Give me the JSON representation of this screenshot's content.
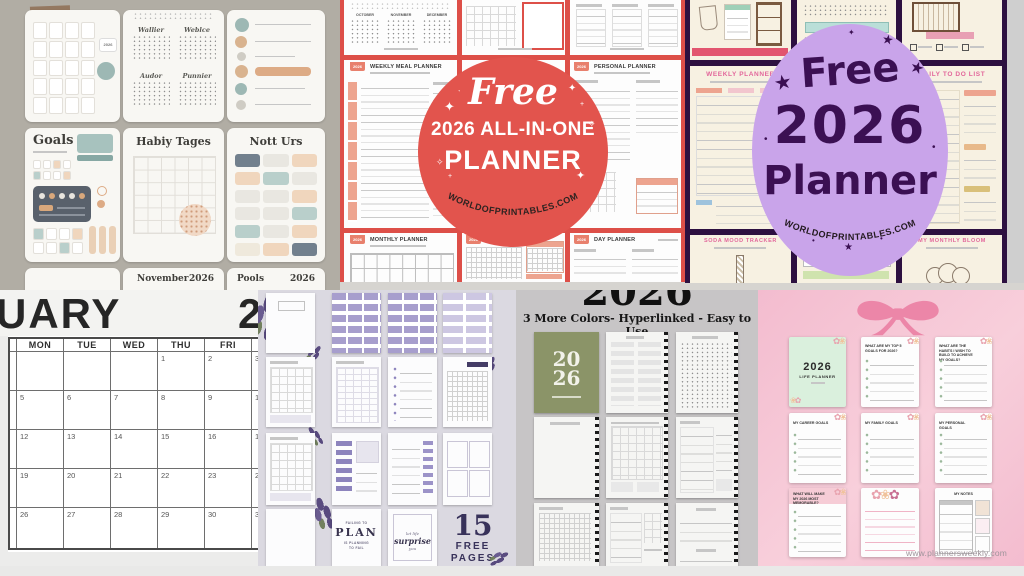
{
  "icons": {
    "sparkle": "✦",
    "sparkle_small": "✧",
    "twinkle": "˖",
    "plus": "+",
    "star": "★",
    "dot": "•",
    "flower": "✿",
    "flower_alt": "❀"
  },
  "boho_panel": {
    "mini_months": [
      "Wallier",
      "Weblce",
      "Audor",
      "Punnier"
    ],
    "calendar_badge_year": "2026",
    "goals_title": "Goals",
    "habit_title": "Habiy Tages",
    "notes_title": "Nott Urs",
    "month_page_label": "November",
    "month_page_year": "2026",
    "pools_page_label": "Pools",
    "pools_page_year": "2026"
  },
  "red_panel": {
    "badge": {
      "line1": "Free",
      "line2": "2026 ALL-IN-ONE",
      "line3": "PLANNER",
      "site": "WORLDOFPRINTABLES.COM"
    },
    "mini_months": [
      "OCTOBER",
      "NOVEMBER",
      "DECEMBER"
    ],
    "tab_year": "2026",
    "pages": {
      "weekly_meal": "WEEKLY MEAL PLANNER",
      "personal": "PERSONAL PLANNER",
      "monthly": "MONTHLY PLANNER",
      "habit": "HABIT TRACKER",
      "day": "DAY PLANNER"
    }
  },
  "purple_panel": {
    "badge": {
      "line1": "Free",
      "line2": "2026",
      "line3": "Planner",
      "site": "WORLDOFPRINTABLES.COM"
    },
    "pages": {
      "weekly": "WEEKLY PLANNER",
      "daily": "DAILY TO DO LIST",
      "mood": "SODA MOOD TRACKER",
      "monthly": "MY MONTHLY BLOOM"
    }
  },
  "january_calendar": {
    "title_visible": "UARY",
    "year_visible": "2",
    "weekdays": [
      "MON",
      "TUE",
      "WED",
      "THU",
      "FRI"
    ],
    "weeks": [
      [
        "",
        "",
        "",
        "1",
        "2",
        "3"
      ],
      [
        "5",
        "6",
        "7",
        "8",
        "9",
        "10"
      ],
      [
        "12",
        "13",
        "14",
        "15",
        "16",
        "17"
      ],
      [
        "19",
        "20",
        "21",
        "22",
        "23",
        "24"
      ],
      [
        "26",
        "27",
        "28",
        "29",
        "30",
        "31"
      ]
    ]
  },
  "lavender_panel": {
    "plan_quote": {
      "pre": "FAILING TO",
      "word": "PLAN",
      "post1": "IS PLANNING",
      "post2": "TO FAIL"
    },
    "surprise_quote": {
      "pre": "let life",
      "word": "surprise",
      "post": "you"
    },
    "free_pages": {
      "count": "15",
      "line1": "FREE",
      "line2": "PAGES"
    }
  },
  "sage_panel": {
    "header_year": "2026",
    "subtitle": "3 More Colors- Hyperlinked - Easy to Use",
    "cover_top": "20",
    "cover_bottom": "26"
  },
  "pink_panel": {
    "cover": {
      "year": "2026",
      "label": "LIFE PLANNER"
    },
    "card_titles": [
      "WHAT ARE MY TOP 5 GOALS FOR 2026?",
      "WHAT ARE THE HABITS I WISH TO BUILD TO ACHIEVE MY GOALS?",
      "MY CAREER GOALS",
      "MY FAMILY GOALS",
      "MY PERSONAL GOALS",
      "WHAT WILL MAKE MY 2026 MOST MEMORABLE?",
      "MY NOTES"
    ],
    "watermark": "www.plannersweekly.com"
  }
}
